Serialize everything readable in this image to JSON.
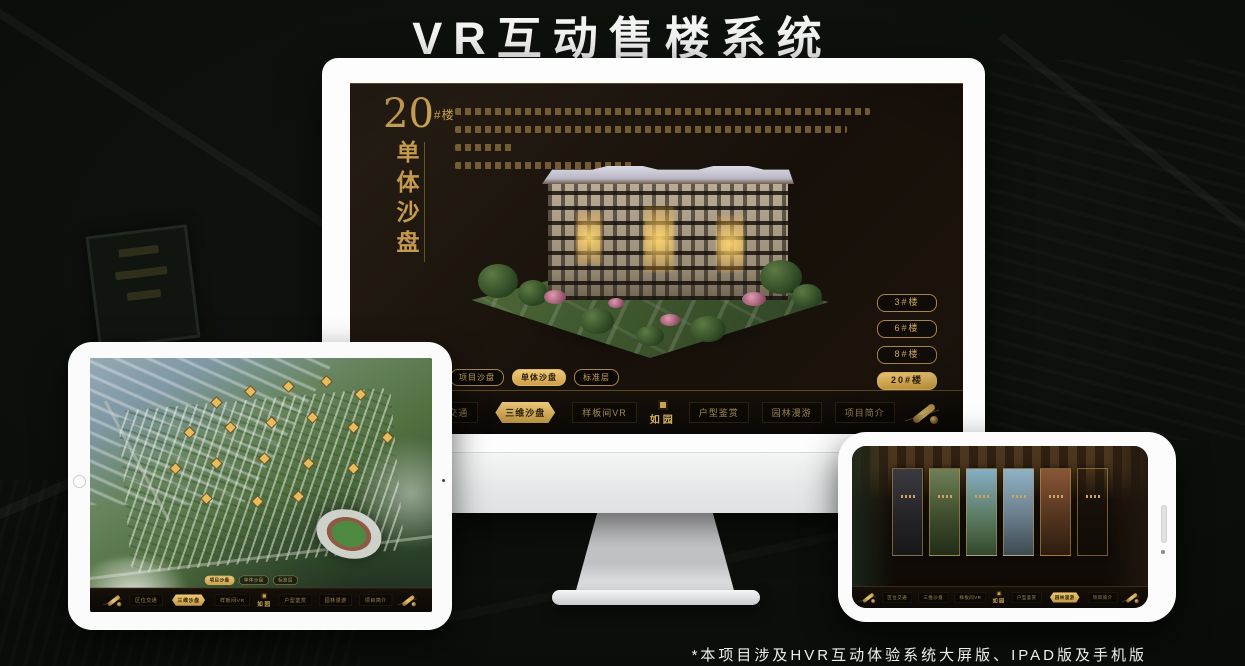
{
  "page": {
    "title": "VR互动售楼系统",
    "footnote": "*本项目涉及HVR互动体验系统大屏版、IPAD版及手机版",
    "accent_color": "#d2ab5c",
    "background_color": "#0a0d0a"
  },
  "screen_ui": {
    "block_number": "20",
    "block_unit": "#楼",
    "block_vertical_title": "单体沙盘",
    "floors": [
      "3#楼",
      "6#楼",
      "8#楼",
      "20#楼"
    ],
    "active_floor": "20#楼",
    "subtabs": [
      "项目沙盘",
      "单体沙盘",
      "标准层"
    ],
    "monitor_active_subtab": "单体沙盘",
    "tablet_active_subtab": "项目沙盘"
  },
  "nav": {
    "items": [
      "区位交通",
      "三维沙盘",
      "样板间VR",
      "户型鉴赏",
      "园林漫游",
      "项目简介"
    ],
    "logo": "如园",
    "monitor_active": "三维沙盘",
    "tablet_active": "三维沙盘",
    "phone_active": "园林漫游"
  }
}
